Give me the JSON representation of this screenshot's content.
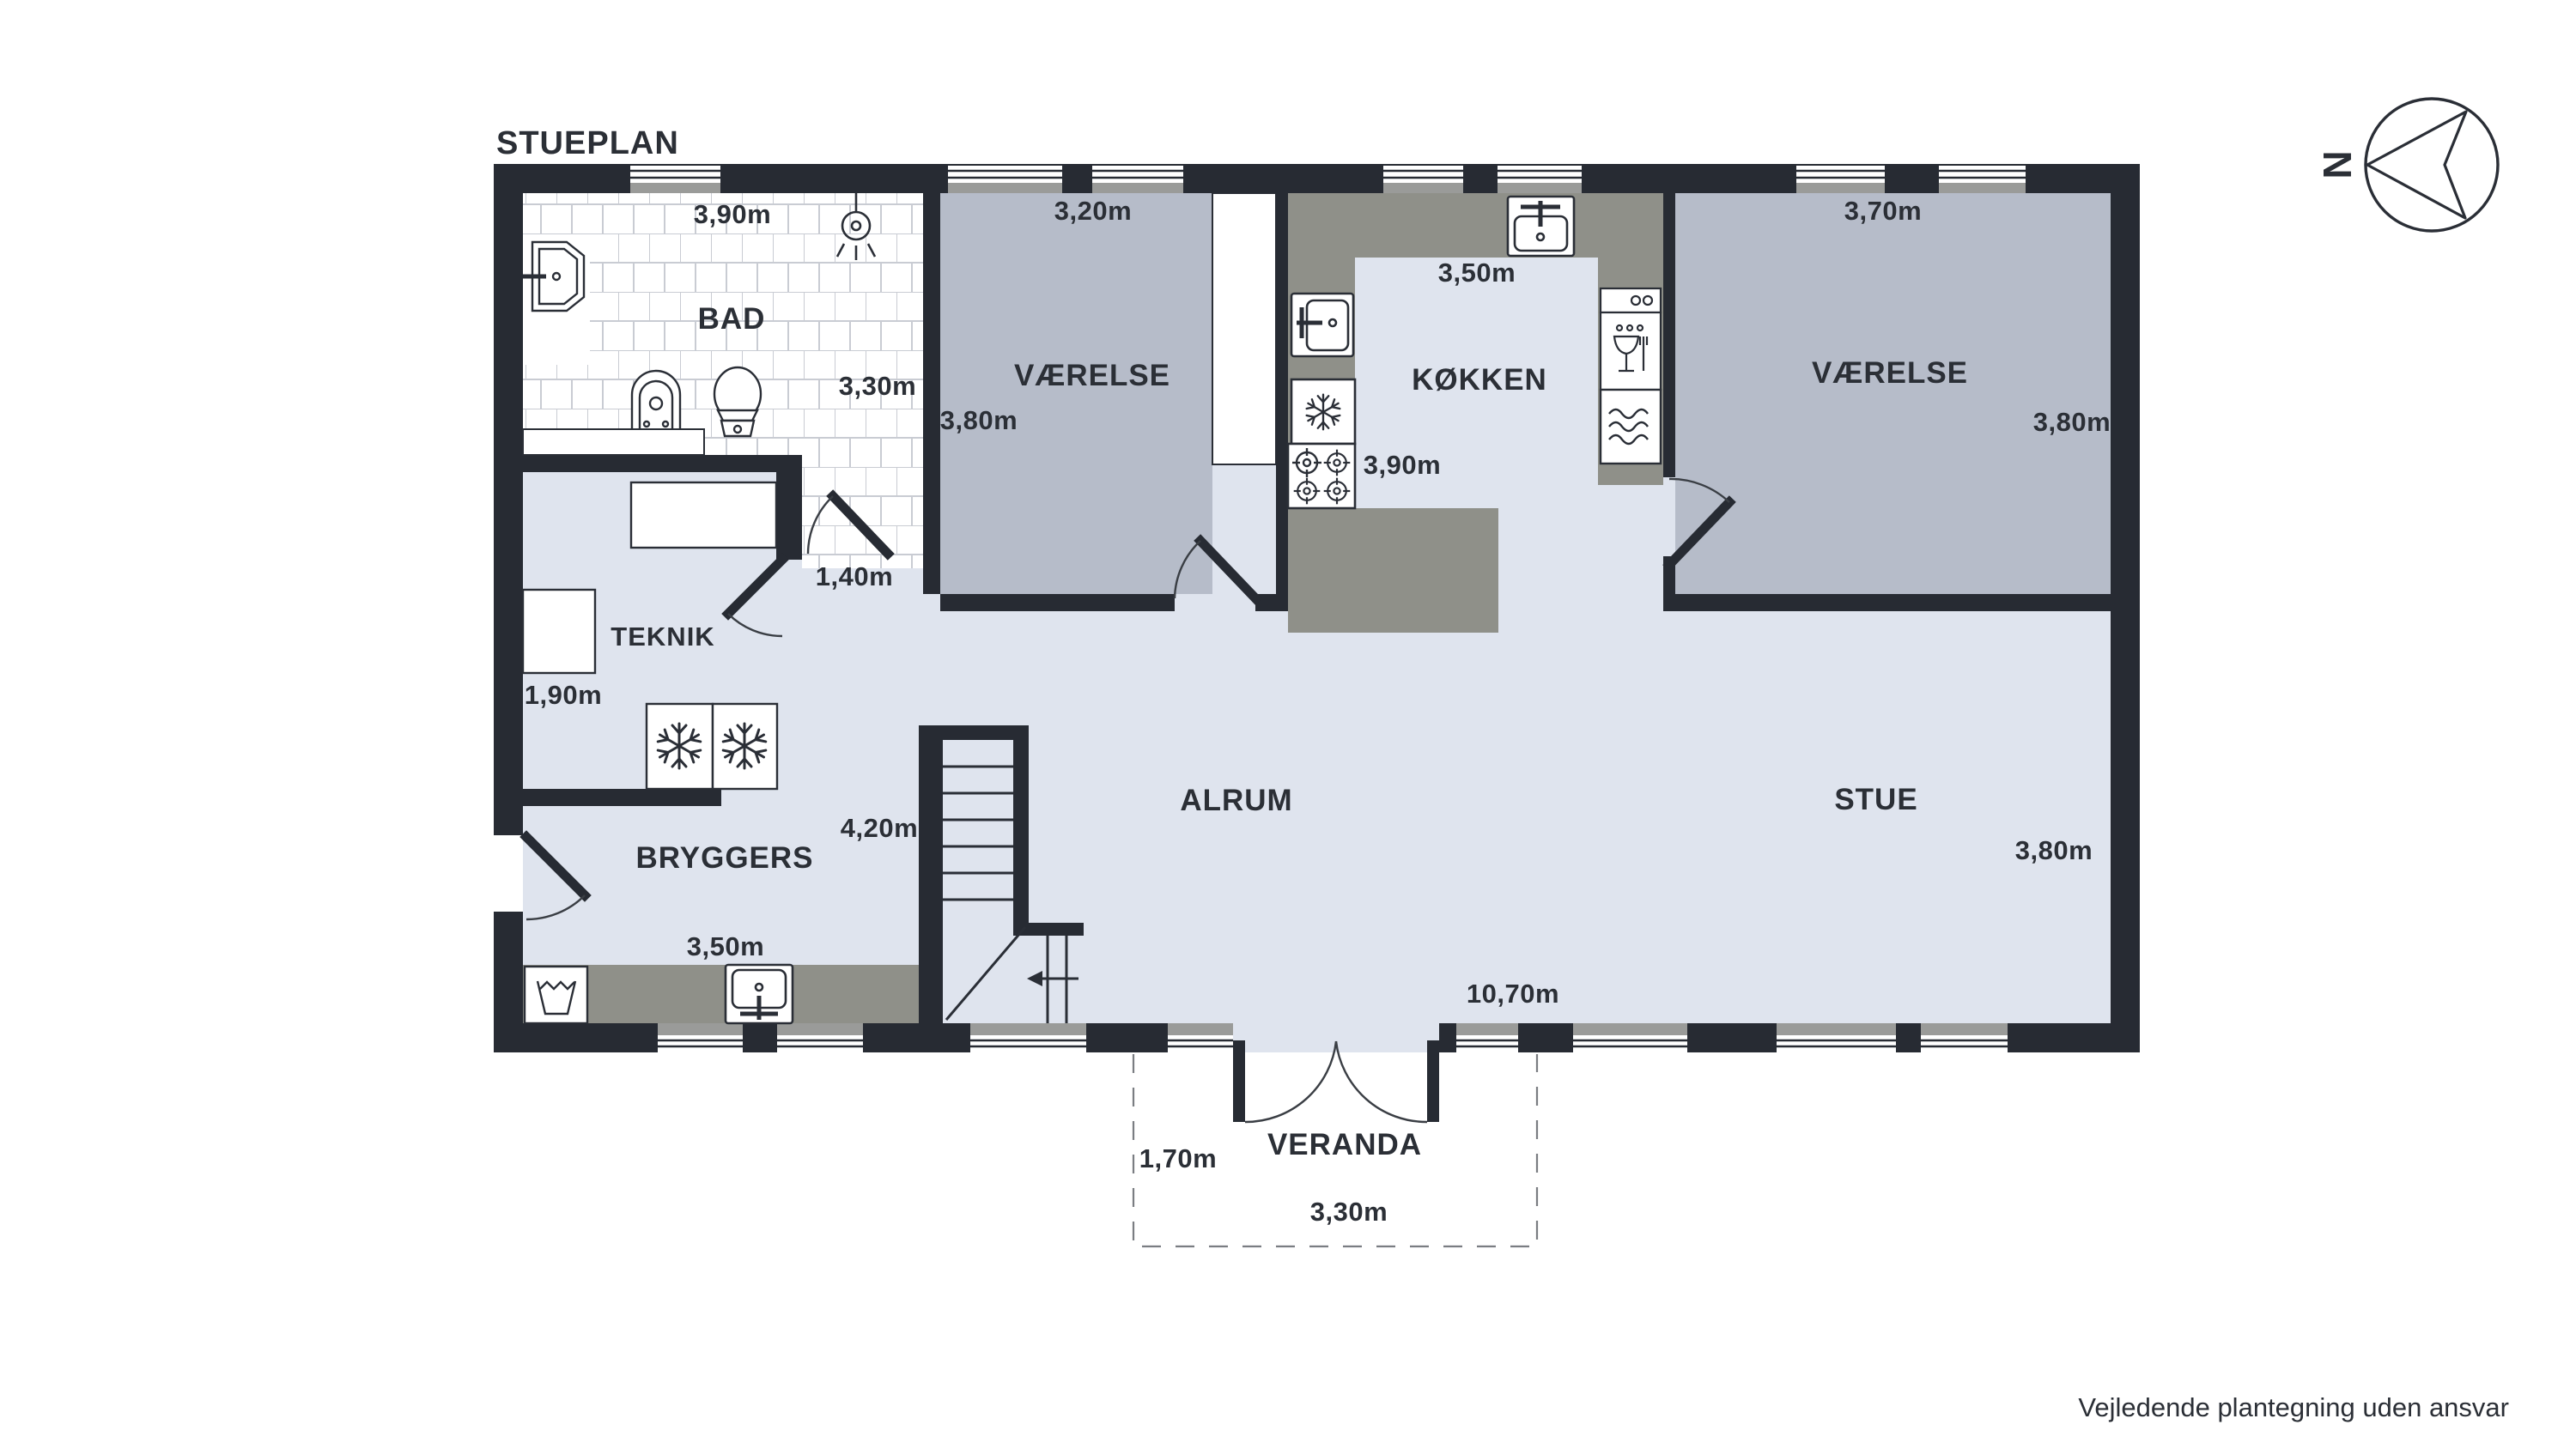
{
  "floorplan": {
    "title": "STUEPLAN",
    "compass_letter": "N",
    "disclaimer": "Vejledende plantegning uden ansvar",
    "rooms": {
      "bad": {
        "name": "BAD",
        "width_label": "3,90m",
        "depth_label": "3,30m"
      },
      "vaerelse1": {
        "name": "VÆRELSE",
        "width_label": "3,20m",
        "depth_label": "3,80m"
      },
      "koekken": {
        "name": "KØKKEN",
        "width_label": "3,50m",
        "depth_label": "3,90m"
      },
      "vaerelse2": {
        "name": "VÆRELSE",
        "width_label": "3,70m",
        "depth_label": "3,80m"
      },
      "teknik": {
        "name": "TEKNIK",
        "width_label": "1,90m"
      },
      "bryggers": {
        "name": "BRYGGERS",
        "width_label": "3,50m",
        "depth_label": "4,20m"
      },
      "alrum": {
        "name": "ALRUM"
      },
      "stue": {
        "name": "STUE",
        "depth_label": "3,80m"
      },
      "veranda": {
        "name": "VERANDA",
        "width_label": "3,30m",
        "depth_label": "1,70m"
      }
    },
    "hall_width_label": "1,40m",
    "house_width_label": "10,70m",
    "colors": {
      "wall": "#272b33",
      "floor_light": "#dfe4ee",
      "floor_grey": "#b6bcc9",
      "counter_grey": "#8f9089",
      "window_sill": "#9a9b99",
      "tile_line": "#c9ccd3",
      "text": "#2b2f36"
    }
  }
}
